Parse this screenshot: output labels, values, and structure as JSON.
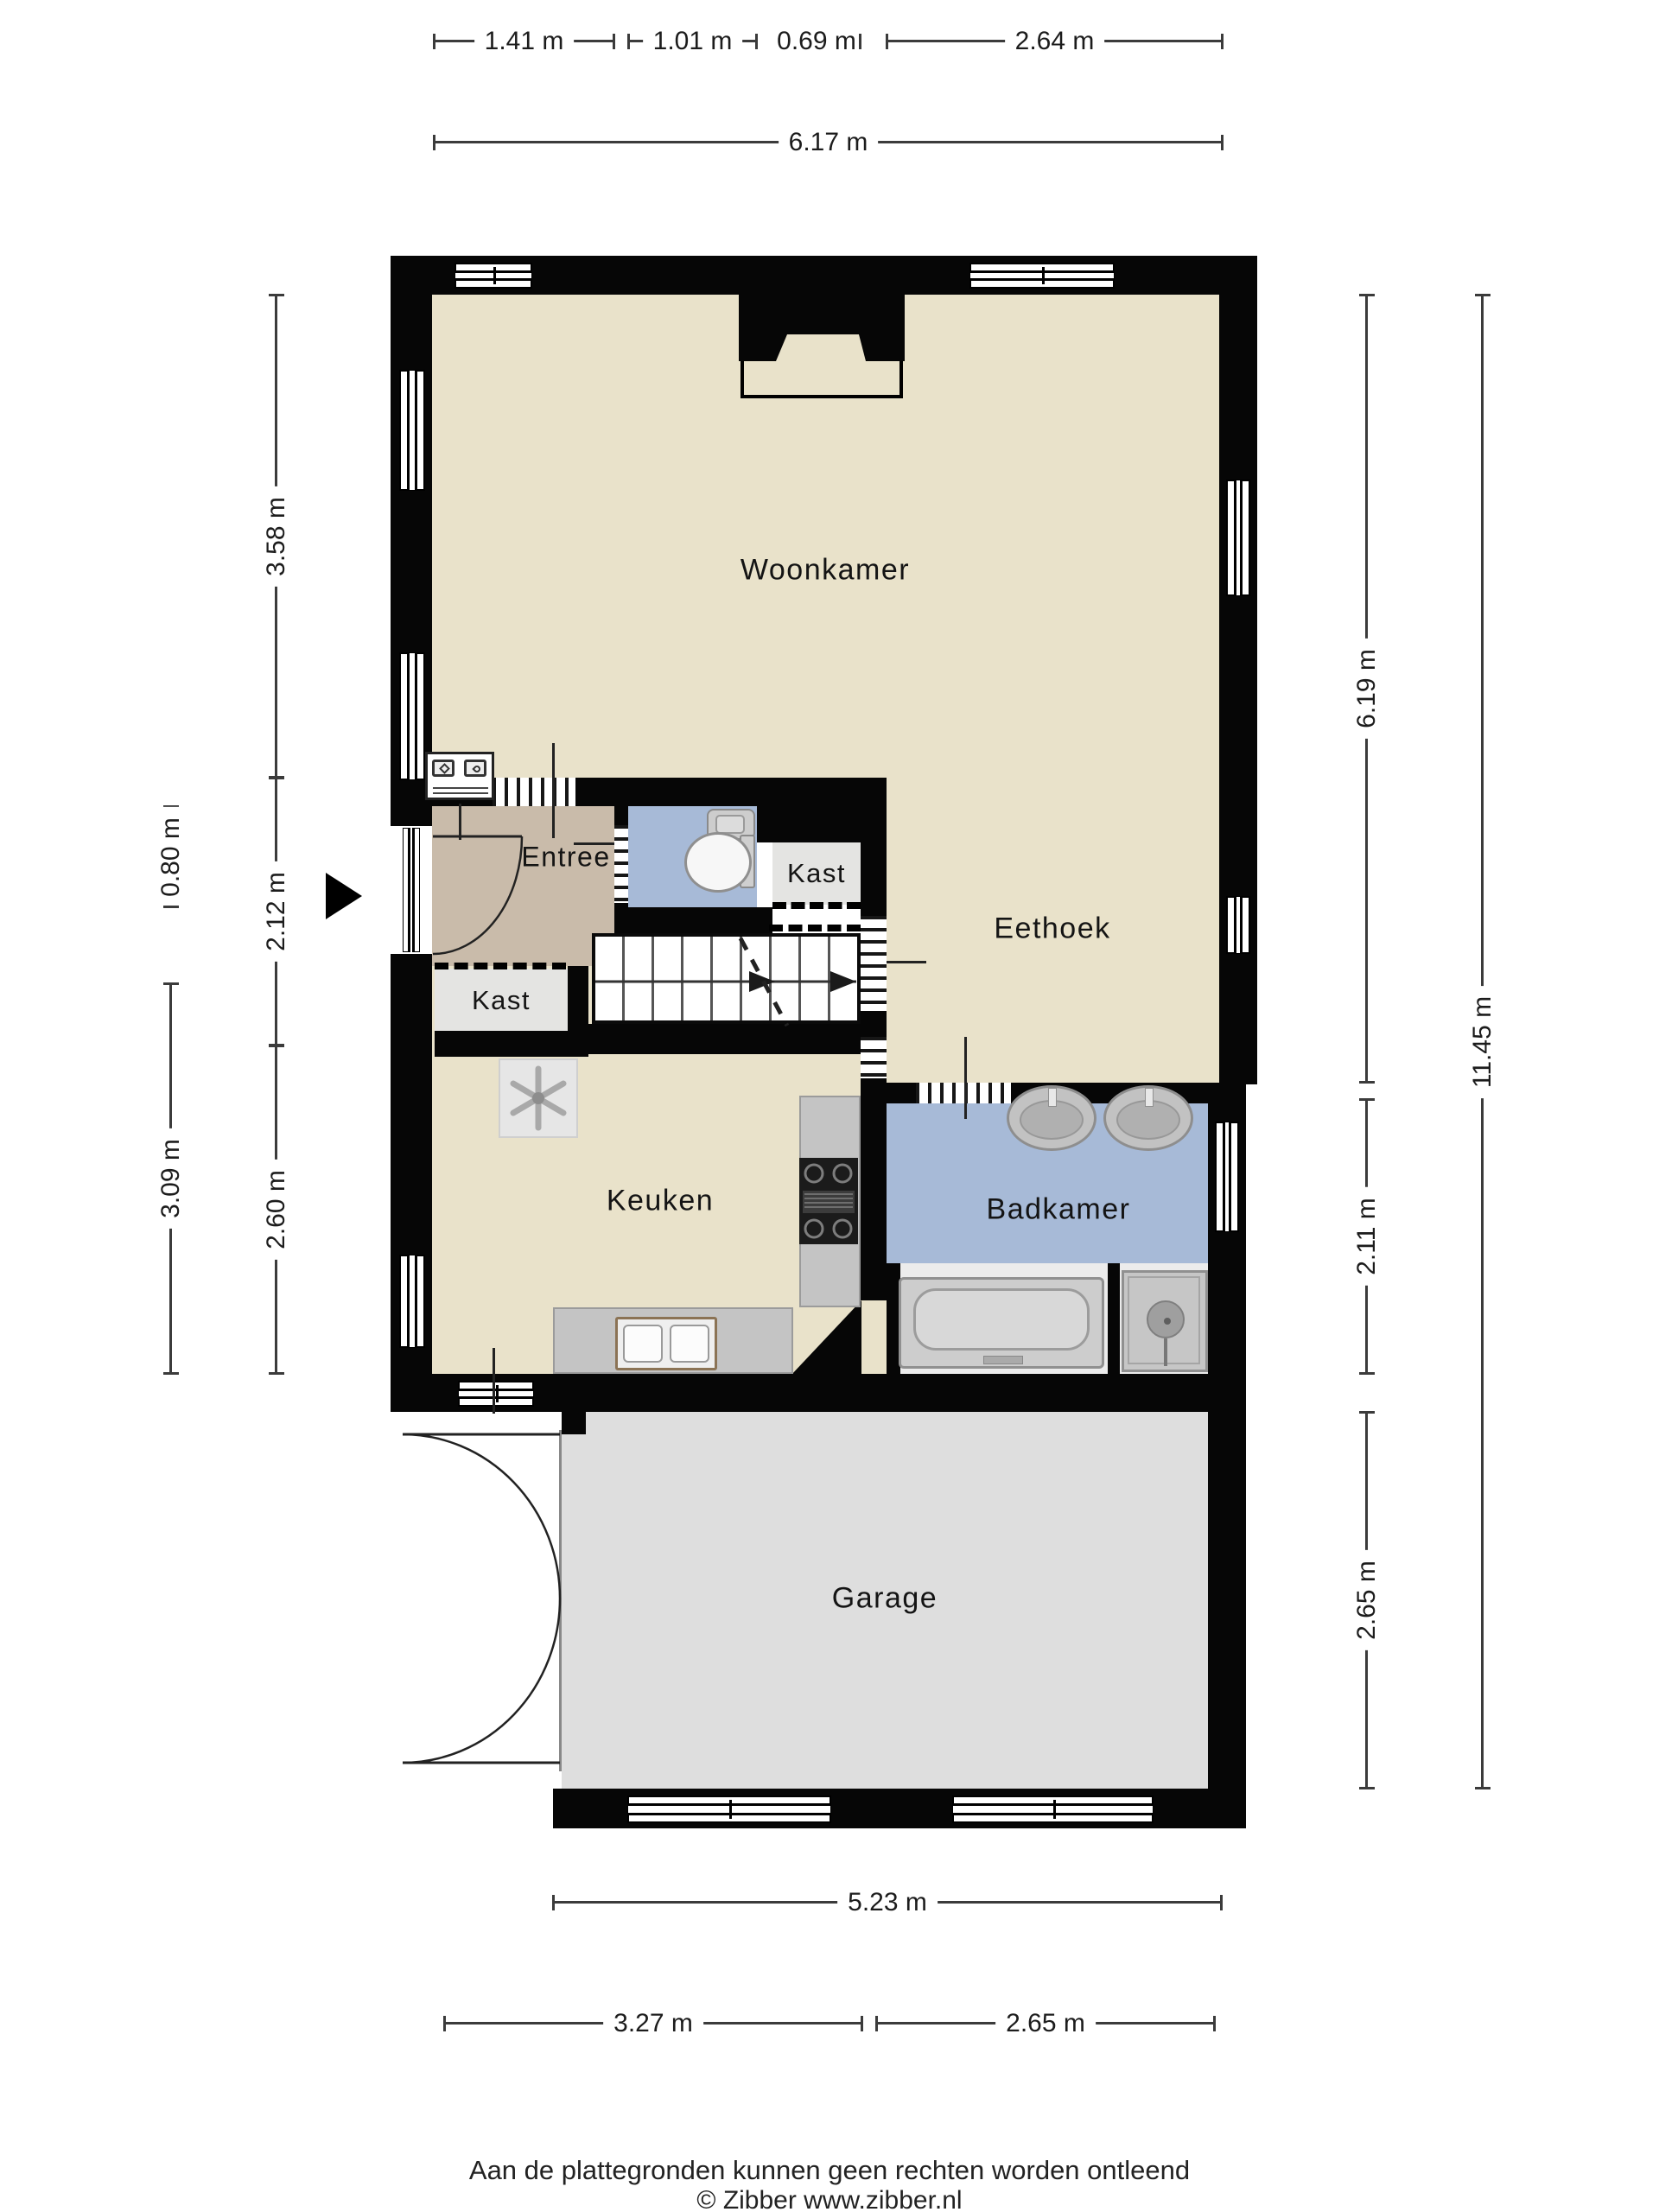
{
  "rooms": {
    "woonkamer": "Woonkamer",
    "eethoek": "Eethoek",
    "entree": "Entree",
    "kast_upper": "Kast",
    "kast_lower": "Kast",
    "keuken": "Keuken",
    "badkamer": "Badkamer",
    "garage": "Garage"
  },
  "dimensions": {
    "top_segments": [
      "1.41 m",
      "1.01 m",
      "0.69 m",
      "2.64 m"
    ],
    "top_total": "6.17 m",
    "left_inner": [
      "3.58 m",
      "2.12 m",
      "2.60 m"
    ],
    "left_outer": [
      "0.80 m",
      "3.09 m"
    ],
    "right_inner": [
      "6.19 m",
      "2.11 m",
      "2.65 m"
    ],
    "right_outer": "11.45 m",
    "bottom_total": "5.23 m",
    "bottom_segments": [
      "3.27 m",
      "2.65 m"
    ]
  },
  "footer": {
    "line1": "Aan de plattegronden kunnen geen rechten worden ontleend",
    "line2": "© Zibber www.zibber.nl"
  },
  "colors": {
    "wall": "#060606",
    "floor_living": "#e9e2ca",
    "floor_entree": "#c9bbaa",
    "floor_bath": "#a7bad7",
    "floor_closet": "#e4e4e2",
    "floor_garage": "#dedede",
    "counter": "#c4c4c4",
    "dim_line": "#3b3b3b"
  }
}
